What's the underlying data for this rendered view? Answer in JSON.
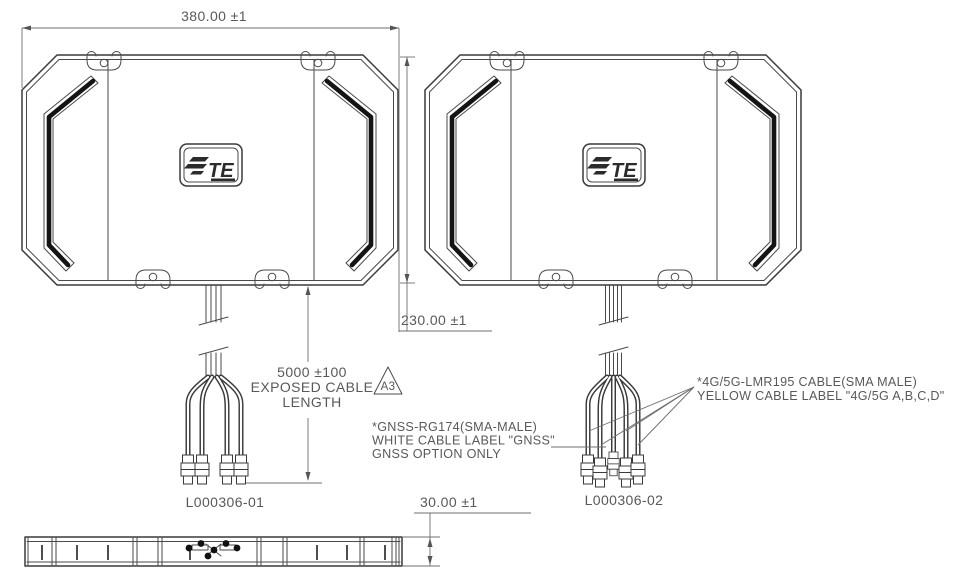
{
  "dimensions": {
    "width_label": "380.00 ±1",
    "height_label": "230.00 ±1",
    "thickness_label": "30.00 ±1",
    "cable_length": [
      "5000 ±100",
      "EXPOSED CABLE",
      "LENGTH"
    ]
  },
  "flags": {
    "triangle": "A3"
  },
  "notes": {
    "gnss": [
      "*GNSS-RG174(SMA-MALE)",
      "WHITE CABLE LABEL \"GNSS\"",
      "GNSS OPTION ONLY"
    ],
    "cellular": [
      "*4G/5G-LMR195 CABLE(SMA MALE)",
      "YELLOW CABLE LABEL \"4G/5G A,B,C,D\""
    ]
  },
  "parts": {
    "left": "L000306-01",
    "right": "L000306-02"
  },
  "logo": {
    "brand": "TE"
  },
  "colors": {
    "line": "#3a3a3a",
    "dim_line": "#6f6f6f",
    "text": "#595959",
    "accent": "#141414",
    "background": "#ffffff"
  }
}
